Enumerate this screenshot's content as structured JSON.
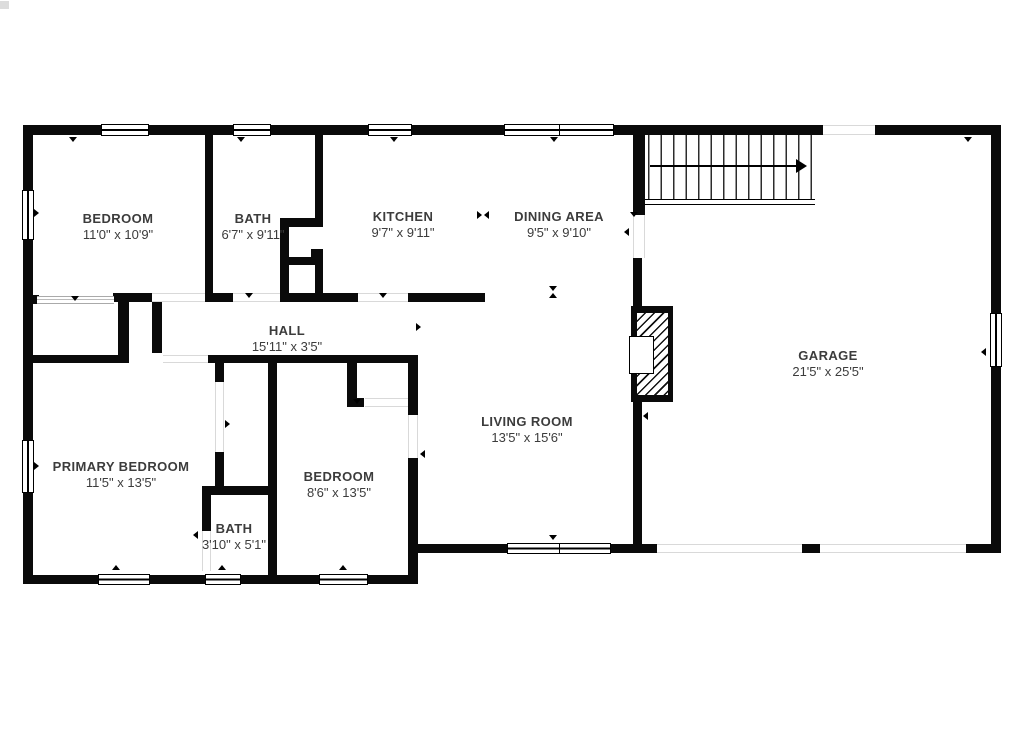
{
  "floorplan": {
    "title": "Main level floor plan",
    "rooms": [
      {
        "name": "BEDROOM",
        "dims": "11'0\" x 10'9\""
      },
      {
        "name": "BATH",
        "dims": "6'7\" x 9'11\""
      },
      {
        "name": "KITCHEN",
        "dims": "9'7\" x 9'11\""
      },
      {
        "name": "DINING AREA",
        "dims": "9'5\" x 9'10\""
      },
      {
        "name": "HALL",
        "dims": "15'11\" x 3'5\""
      },
      {
        "name": "GARAGE",
        "dims": "21'5\" x 25'5\""
      },
      {
        "name": "LIVING ROOM",
        "dims": "13'5\" x 15'6\""
      },
      {
        "name": "PRIMARY BEDROOM",
        "dims": "11'5\" x 13'5\""
      },
      {
        "name": "BEDROOM",
        "dims": "8'6\" x 13'5\""
      },
      {
        "name": "BATH",
        "dims": "3'10\" x 5'1\""
      }
    ],
    "colors": {
      "wall": "#0a0a0a",
      "background": "#ffffff",
      "label_text": "#3c3c3c"
    }
  }
}
